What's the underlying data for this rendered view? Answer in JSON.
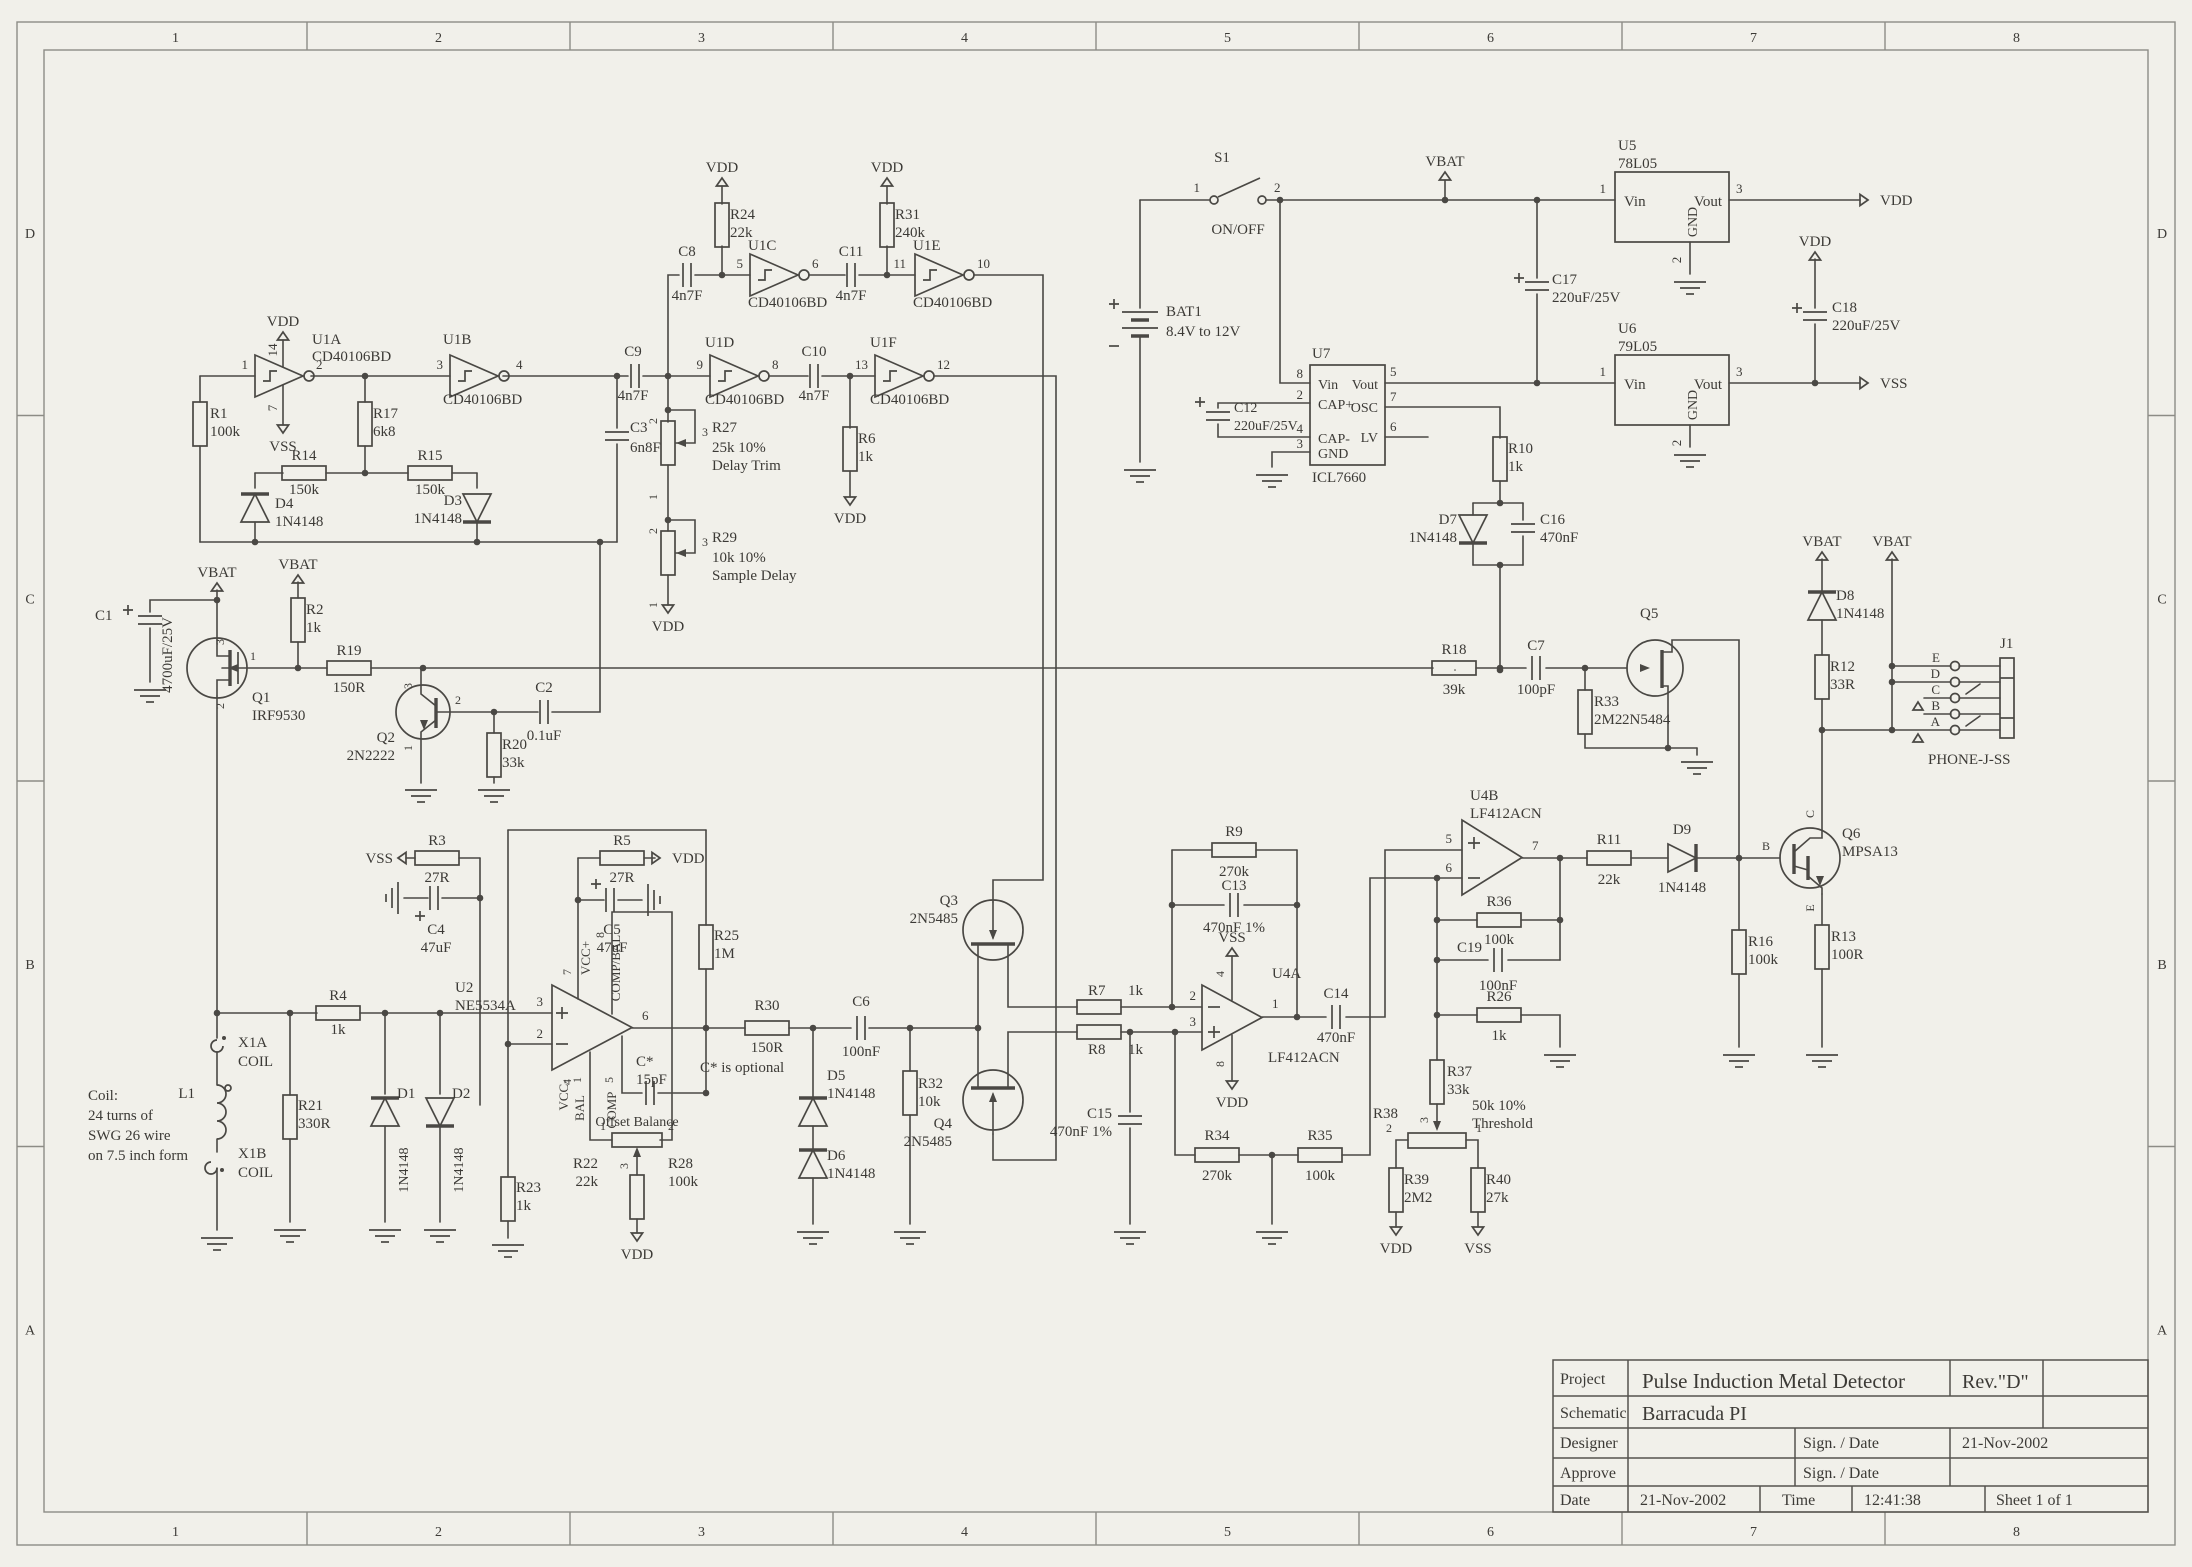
{
  "sheet": {
    "zone_numbers": [
      "1",
      "2",
      "3",
      "4",
      "5",
      "6",
      "7",
      "8"
    ],
    "zone_letters": [
      "D",
      "C",
      "B",
      "A"
    ]
  },
  "title_block": {
    "project_label": "Project",
    "project": "Pulse Induction Metal Detector",
    "rev": "Rev.\"D\"",
    "schematic_label": "Schematic",
    "schematic": "Barracuda PI",
    "designer_label": "Designer",
    "approve_label": "Approve",
    "sign_date_label": "Sign. / Date",
    "designer_date": "21-Nov-2002",
    "date_label": "Date",
    "date": "21-Nov-2002",
    "time_label": "Time",
    "time": "12:41:38",
    "sheet_info": "Sheet  1    of    1"
  },
  "power": {
    "vdd": "VDD",
    "vss": "VSS",
    "vbat": "VBAT"
  },
  "notes": {
    "coil": [
      "Coil:",
      "24 turns of",
      "SWG 26 wire",
      "on 7.5 inch form"
    ],
    "c_star": "C* is optional",
    "offset": "Offset Balance"
  },
  "components": {
    "R1": {
      "ref": "R1",
      "value": "100k"
    },
    "R2": {
      "ref": "R2",
      "value": "1k"
    },
    "R3": {
      "ref": "R3",
      "value": "27R"
    },
    "R4": {
      "ref": "R4",
      "value": "1k"
    },
    "R5": {
      "ref": "R5",
      "value": "27R"
    },
    "R6": {
      "ref": "R6",
      "value": "1k"
    },
    "R7": {
      "ref": "R7",
      "value": "1k"
    },
    "R8": {
      "ref": "R8",
      "value": "1k"
    },
    "R9": {
      "ref": "R9",
      "value": "270k"
    },
    "R10": {
      "ref": "R10",
      "value": "1k"
    },
    "R11": {
      "ref": "R11",
      "value": "22k"
    },
    "R12": {
      "ref": "R12",
      "value": "33R"
    },
    "R13": {
      "ref": "R13",
      "value": "100R"
    },
    "R14": {
      "ref": "R14",
      "value": "150k"
    },
    "R15": {
      "ref": "R15",
      "value": "150k"
    },
    "R16": {
      "ref": "R16",
      "value": "100k"
    },
    "R17": {
      "ref": "R17",
      "value": "6k8"
    },
    "R18": {
      "ref": "R18",
      "value": "39k"
    },
    "R19": {
      "ref": "R19",
      "value": "150R"
    },
    "R20": {
      "ref": "R20",
      "value": "33k"
    },
    "R21": {
      "ref": "R21",
      "value": "330R"
    },
    "R22": {
      "ref": "R22",
      "value": "22k"
    },
    "R23": {
      "ref": "R23",
      "value": "1k"
    },
    "R24": {
      "ref": "R24",
      "value": "22k"
    },
    "R25": {
      "ref": "R25",
      "value": "1M"
    },
    "R26": {
      "ref": "R26",
      "value": "1k"
    },
    "R27": {
      "ref": "R27",
      "value": "25k 10%",
      "desc": "Delay Trim",
      "pins": [
        "2",
        "3",
        "1"
      ]
    },
    "R28": {
      "ref": "R28",
      "value": "100k",
      "pins": [
        "1",
        "2",
        "3"
      ]
    },
    "R29": {
      "ref": "R29",
      "value": "10k 10%",
      "desc": "Sample Delay",
      "pins": [
        "2",
        "3",
        "1"
      ]
    },
    "R30": {
      "ref": "R30",
      "value": "150R"
    },
    "R31": {
      "ref": "R31",
      "value": "240k"
    },
    "R32": {
      "ref": "R32",
      "value": "10k"
    },
    "R33": {
      "ref": "R33",
      "value": "2M2"
    },
    "R34": {
      "ref": "R34",
      "value": "270k"
    },
    "R35": {
      "ref": "R35",
      "value": "100k"
    },
    "R36": {
      "ref": "R36",
      "value": "100k"
    },
    "R37": {
      "ref": "R37",
      "value": "33k",
      "pins": [
        "3"
      ]
    },
    "R38": {
      "ref": "R38",
      "value": "50k 10%",
      "desc": "Threshold",
      "pins": [
        "2",
        "1"
      ]
    },
    "R39": {
      "ref": "R39",
      "value": "2M2"
    },
    "R40": {
      "ref": "R40",
      "value": "27k"
    },
    "C1": {
      "ref": "C1",
      "value": "4700uF/25V"
    },
    "C2": {
      "ref": "C2",
      "value": "0.1uF"
    },
    "C3": {
      "ref": "C3",
      "value": "6n8F"
    },
    "C4": {
      "ref": "C4",
      "value": "47uF"
    },
    "C5": {
      "ref": "C5",
      "value": "47uF"
    },
    "C6": {
      "ref": "C6",
      "value": "100nF"
    },
    "C7": {
      "ref": "C7",
      "value": "100pF"
    },
    "C8": {
      "ref": "C8",
      "value": "4n7F"
    },
    "C9": {
      "ref": "C9",
      "value": "4n7F"
    },
    "C10": {
      "ref": "C10",
      "value": "4n7F"
    },
    "C11": {
      "ref": "C11",
      "value": "4n7F"
    },
    "C12": {
      "ref": "C12",
      "value": "220uF/25V"
    },
    "C13": {
      "ref": "C13",
      "value": "470nF 1%"
    },
    "C14": {
      "ref": "C14",
      "value": "470nF"
    },
    "C15": {
      "ref": "C15",
      "value": "470nF 1%"
    },
    "C16": {
      "ref": "C16",
      "value": "470nF"
    },
    "C17": {
      "ref": "C17",
      "value": "220uF/25V"
    },
    "C18": {
      "ref": "C18",
      "value": "220uF/25V"
    },
    "C19": {
      "ref": "C19",
      "value": "100nF"
    },
    "Cstar": {
      "ref": "C*",
      "value": "15pF"
    },
    "D1": {
      "ref": "D1",
      "value": "1N4148"
    },
    "D2": {
      "ref": "D2",
      "value": "1N4148"
    },
    "D3": {
      "ref": "D3",
      "value": "1N4148"
    },
    "D4": {
      "ref": "D4",
      "value": "1N4148"
    },
    "D5": {
      "ref": "D5",
      "value": "1N4148"
    },
    "D6": {
      "ref": "D6",
      "value": "1N4148"
    },
    "D7": {
      "ref": "D7",
      "value": "1N4148"
    },
    "D8": {
      "ref": "D8",
      "value": "1N4148"
    },
    "D9": {
      "ref": "D9",
      "value": "1N4148"
    },
    "Q1": {
      "ref": "Q1",
      "part": "IRF9530",
      "pins": [
        "3",
        "1",
        "2"
      ]
    },
    "Q2": {
      "ref": "Q2",
      "part": "2N2222",
      "pins": [
        "3",
        "2",
        "1"
      ]
    },
    "Q3": {
      "ref": "Q3",
      "part": "2N5485"
    },
    "Q4": {
      "ref": "Q4",
      "part": "2N5485"
    },
    "Q5": {
      "ref": "Q5",
      "part": "2N5484"
    },
    "Q6": {
      "ref": "Q6",
      "part": "MPSA13",
      "pins": [
        "C",
        "B",
        "E"
      ]
    },
    "U1A": {
      "ref": "U1A",
      "part": "CD40106BD",
      "pins": [
        "1",
        "2",
        "14",
        "7"
      ]
    },
    "U1B": {
      "ref": "U1B",
      "part": "CD40106BD",
      "pins": [
        "3",
        "4"
      ]
    },
    "U1C": {
      "ref": "U1C",
      "part": "CD40106BD",
      "pins": [
        "5",
        "6"
      ]
    },
    "U1D": {
      "ref": "U1D",
      "part": "CD40106BD",
      "pins": [
        "9",
        "8"
      ]
    },
    "U1E": {
      "ref": "U1E",
      "part": "CD40106BD",
      "pins": [
        "11",
        "10"
      ]
    },
    "U1F": {
      "ref": "U1F",
      "part": "CD40106BD",
      "pins": [
        "13",
        "12"
      ]
    },
    "U2": {
      "ref": "U2",
      "part": "NE5534A",
      "pins": [
        "3",
        "2",
        "6",
        "7",
        "4",
        "8",
        "1",
        "5"
      ],
      "pin_names": [
        "VCC+",
        "VCC-",
        "COMP/BAL",
        "BAL",
        "COMP"
      ]
    },
    "U4A": {
      "ref": "U4A",
      "part": "LF412ACN",
      "pins": [
        "2",
        "3",
        "1",
        "4",
        "8"
      ]
    },
    "U4B": {
      "ref": "U4B",
      "part": "LF412ACN",
      "pins": [
        "5",
        "6",
        "7"
      ]
    },
    "U5": {
      "ref": "U5",
      "part": "78L05",
      "pins": [
        "1",
        "3",
        "2"
      ],
      "pin_names": [
        "Vin",
        "Vout",
        "GND"
      ]
    },
    "U6": {
      "ref": "U6",
      "part": "79L05",
      "pins": [
        "1",
        "3",
        "2"
      ],
      "pin_names": [
        "Vin",
        "Vout",
        "GND"
      ]
    },
    "U7": {
      "ref": "U7",
      "part": "ICL7660",
      "pins": [
        "8",
        "2",
        "4",
        "3",
        "5",
        "7",
        "6"
      ],
      "pin_names": [
        "Vin",
        "CAP+",
        "CAP-",
        "GND",
        "Vout",
        "OSC",
        "LV"
      ]
    },
    "S1": {
      "ref": "S1",
      "desc": "ON/OFF",
      "pins": [
        "1",
        "2"
      ]
    },
    "BAT1": {
      "ref": "BAT1",
      "desc": "8.4V to 12V"
    },
    "L1": {
      "ref": "L1"
    },
    "X1A": {
      "ref": "X1A",
      "desc": "COIL"
    },
    "X1B": {
      "ref": "X1B",
      "desc": "COIL"
    },
    "J1": {
      "ref": "J1",
      "part": "PHONE-J-SS",
      "pins": [
        "E",
        "D",
        "C",
        "B",
        "A"
      ]
    }
  }
}
